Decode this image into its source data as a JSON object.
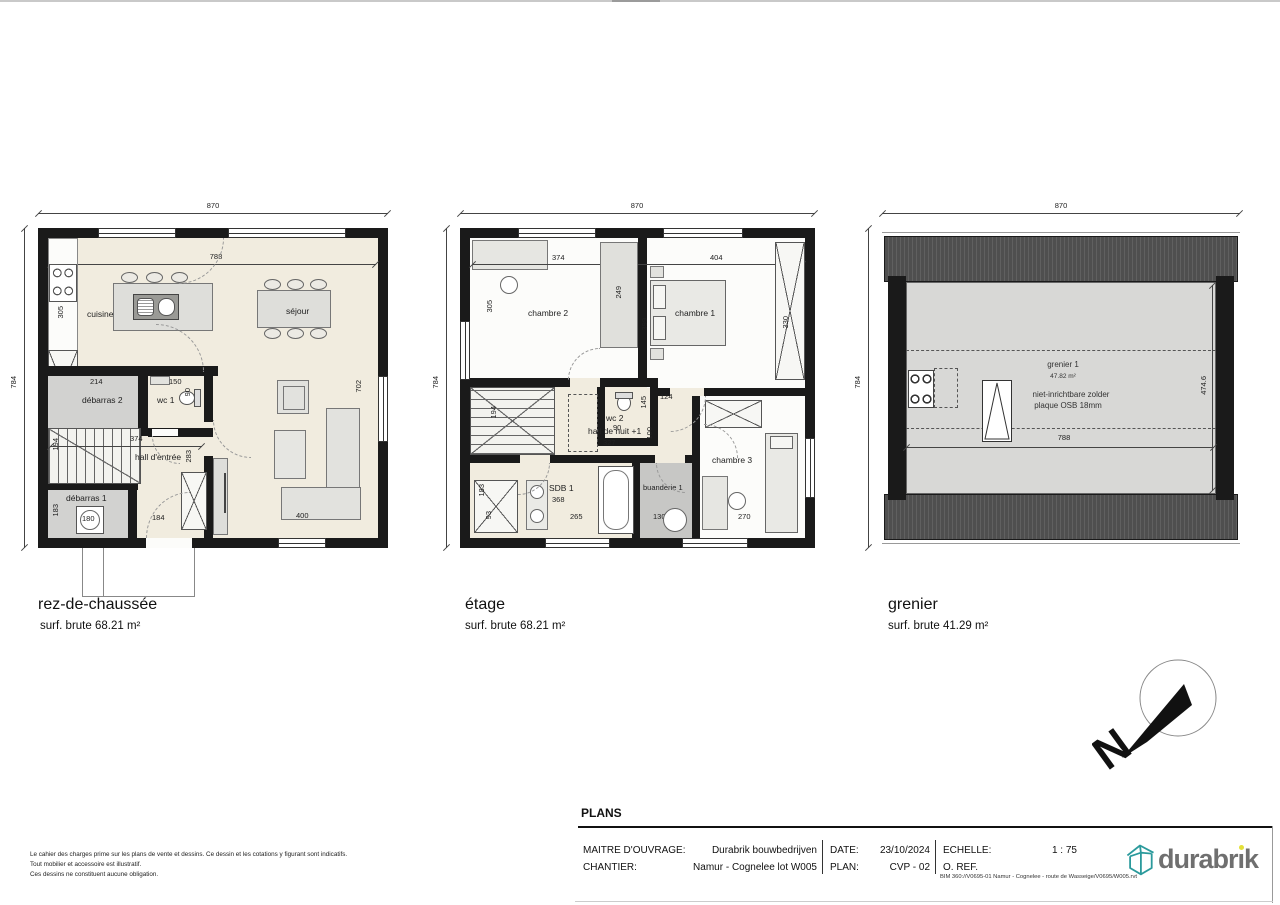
{
  "disclaimer": {
    "line1": "Le cahier des charges prime sur les plans de vente et dessins. Ce dessin et les cotations y figurant sont indicatifs.",
    "line2": "Tout mobilier et accessoire est illustratif.",
    "line3": "Ces dessins ne constituent aucune obligation."
  },
  "plans": {
    "rdc": {
      "title": "rez-de-chaussée",
      "area": "surf. brute 68.21 m²",
      "labels": {
        "cuisine": "cuisine",
        "sejour": "séjour",
        "debarras2": "débarras 2",
        "wc1": "wc 1",
        "debarras1": "débarras 1",
        "hall": "hall d'entrée"
      },
      "dims": {
        "d870": "870",
        "d784": "784",
        "d788": "788",
        "d305": "305",
        "d214": "214",
        "d150": "150",
        "d90": "90",
        "d374": "374",
        "d283": "283",
        "d194": "194",
        "d183": "183",
        "d180": "180",
        "d184": "184",
        "d400": "400",
        "d702": "702"
      }
    },
    "etage": {
      "title": "étage",
      "area": "surf. brute 68.21 m²",
      "labels": {
        "chambre2": "chambre 2",
        "chambre1": "chambre 1",
        "wc2": "wc 2",
        "hall": "hall de nuit +1",
        "sdb": "SDB 1",
        "buanderie": "buanderie 1",
        "chambre3": "chambre 3"
      },
      "dims": {
        "d870": "870",
        "d784": "784",
        "d374": "374",
        "d404": "404",
        "d305": "305",
        "d249": "249",
        "d399": "399",
        "d330": "330",
        "d145": "145",
        "d90": "90",
        "d124": "124",
        "d194": "194",
        "d327": "327",
        "d100": "100",
        "d183": "183",
        "d93": "93",
        "d265": "265",
        "d368": "368",
        "d130": "130",
        "d270": "270",
        "d362": "362"
      }
    },
    "grenier": {
      "title": "grenier",
      "area": "surf. brute 41.29 m²",
      "labels": {
        "grenier1": "grenier 1",
        "area_inner": "47.82 m²",
        "note1": "niet-inrichtbare zolder",
        "note2": "plaque OSB 18mm"
      },
      "dims": {
        "d870": "870",
        "d784": "784",
        "d788": "788",
        "d4746": "474.6"
      }
    }
  },
  "north": {
    "letter": "N"
  },
  "titleblock": {
    "heading": "PLANS",
    "maitre_label": "MAITRE D'OUVRAGE:",
    "maitre_value": "Durabrik bouwbedrijven",
    "chantier_label": "CHANTIER:",
    "chantier_value": "Namur - Cognelee lot W005",
    "date_label": "DATE:",
    "date_value": "23/10/2024",
    "plan_label": "PLAN:",
    "plan_value": "CVP - 02",
    "echelle_label": "ECHELLE:",
    "echelle_value": "1 : 75",
    "oref_label": "O. REF.",
    "bim_path": "BIM 360://V0695-01 Namur - Cognelee - route de Wasseige/V0695/W005.rvt"
  },
  "logo": {
    "pre": "durabr",
    "i": "ı",
    "post": "k"
  }
}
